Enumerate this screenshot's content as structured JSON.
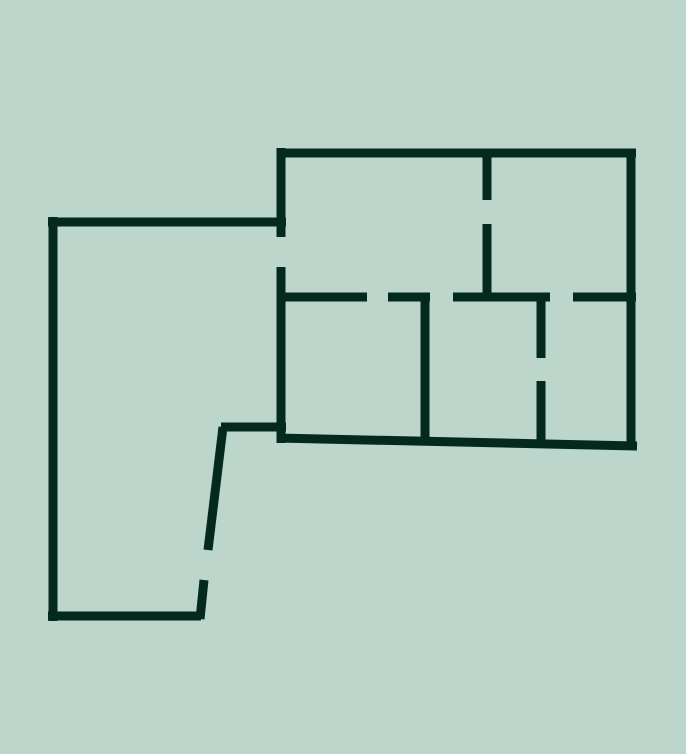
{
  "canvas": {
    "width": 686,
    "height": 754,
    "background_color": "#BCD6CC",
    "wall_color": "#042A1E",
    "wall_thickness": 9
  },
  "floor_plan": {
    "description": "Architectural floor plan outline: large left room joined to a right wing of five rooms, with door openings shown as gaps in the walls",
    "walls": [
      {
        "id": "left-room-top-wall",
        "x1": 48,
        "y1": 222,
        "x2": 286,
        "y2": 222
      },
      {
        "id": "left-room-left-wall",
        "x1": 53,
        "y1": 217,
        "x2": 53,
        "y2": 621
      },
      {
        "id": "left-room-bottom-wall",
        "x1": 48,
        "y1": 616,
        "x2": 201,
        "y2": 616
      },
      {
        "id": "left-room-slanted-wall-upper",
        "x1": 223,
        "y1": 427,
        "x2": 208,
        "y2": 550
      },
      {
        "id": "left-room-slanted-wall-lower",
        "x1": 204,
        "y1": 580,
        "x2": 200,
        "y2": 619
      },
      {
        "id": "left-room-connector-wall",
        "x1": 221,
        "y1": 427,
        "x2": 286,
        "y2": 427
      },
      {
        "id": "right-wing-top-wall",
        "x1": 277,
        "y1": 153,
        "x2": 636,
        "y2": 153
      },
      {
        "id": "right-wing-right-wall",
        "x1": 631,
        "y1": 149,
        "x2": 631,
        "y2": 450
      },
      {
        "id": "right-wing-bottom-wall",
        "x1": 277,
        "y1": 438,
        "x2": 637,
        "y2": 446
      },
      {
        "id": "right-wing-left-wall-upper",
        "x1": 281,
        "y1": 148,
        "x2": 281,
        "y2": 237
      },
      {
        "id": "right-wing-left-wall-lower",
        "x1": 281,
        "y1": 267,
        "x2": 281,
        "y2": 443
      },
      {
        "id": "mid-wall-segment-1",
        "x1": 277,
        "y1": 297,
        "x2": 367,
        "y2": 297
      },
      {
        "id": "mid-wall-segment-2",
        "x1": 388,
        "y1": 297,
        "x2": 430,
        "y2": 297
      },
      {
        "id": "mid-wall-segment-3",
        "x1": 453,
        "y1": 297,
        "x2": 550,
        "y2": 297
      },
      {
        "id": "mid-wall-segment-4",
        "x1": 573,
        "y1": 297,
        "x2": 636,
        "y2": 297
      },
      {
        "id": "upper-room-divider-wall-top",
        "x1": 487,
        "y1": 153,
        "x2": 487,
        "y2": 200
      },
      {
        "id": "upper-room-divider-wall-bottom",
        "x1": 487,
        "y1": 224,
        "x2": 487,
        "y2": 301
      },
      {
        "id": "lower-left-divider-wall",
        "x1": 425,
        "y1": 293,
        "x2": 425,
        "y2": 442
      },
      {
        "id": "lower-right-divider-wall-top",
        "x1": 541,
        "y1": 293,
        "x2": 541,
        "y2": 358
      },
      {
        "id": "lower-right-divider-wall-bottom",
        "x1": 541,
        "y1": 381,
        "x2": 541,
        "y2": 445
      }
    ]
  }
}
